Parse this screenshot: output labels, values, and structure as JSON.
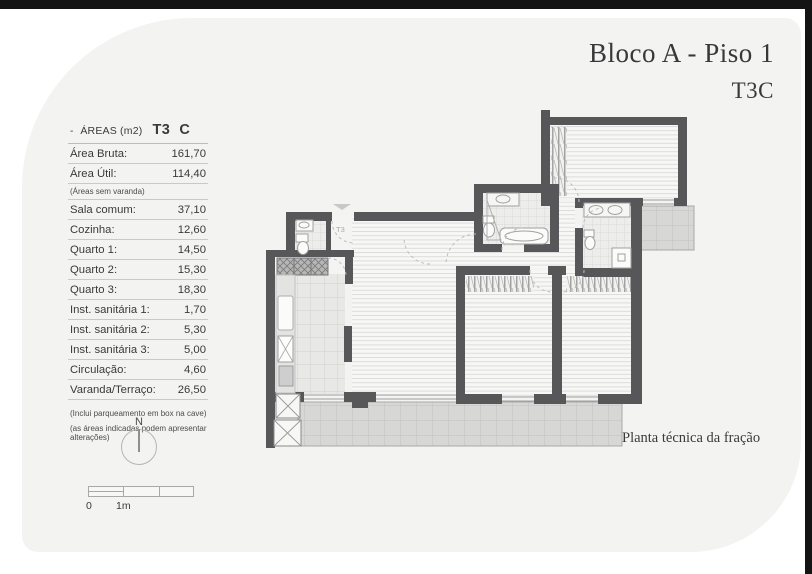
{
  "page": {
    "title_line1": "Bloco A - Piso 1",
    "title_line2": "T3C",
    "plan_caption": "Planta técnica da fração"
  },
  "areas_table": {
    "header": {
      "dash": "-",
      "label": "ÁREAS (m2)",
      "type_code": "T3",
      "fraction": "C"
    },
    "rows": [
      {
        "label": "Área Bruta:",
        "value": "161,70"
      },
      {
        "label": "Área Útil:",
        "value": "114,40"
      },
      {
        "label": "(Áreas sem varanda)",
        "value": "",
        "note": true
      },
      {
        "label": "Sala comum:",
        "value": "37,10"
      },
      {
        "label": "Cozinha:",
        "value": "12,60"
      },
      {
        "label": "Quarto 1:",
        "value": "14,50"
      },
      {
        "label": "Quarto 2:",
        "value": "15,30"
      },
      {
        "label": "Quarto 3:",
        "value": "18,30"
      },
      {
        "label": "Inst. sanitária 1:",
        "value": "1,70"
      },
      {
        "label": "Inst. sanitária 2:",
        "value": "5,30"
      },
      {
        "label": "Inst. sanitária 3:",
        "value": "5,00"
      },
      {
        "label": "Circulação:",
        "value": "4,60"
      },
      {
        "label": "Varanda/Terraço:",
        "value": "26,50"
      }
    ],
    "footnotes": [
      "(Inclui parqueamento em box na cave)",
      "(as áreas indicadas podem apresentar alterações)"
    ]
  },
  "compass": {
    "label": "N"
  },
  "scale_bar": {
    "zero_label": "0",
    "one_label": "1m"
  },
  "plan": {
    "unit_label": "T3"
  },
  "colors": {
    "wall": "#57575a",
    "sheet": "#f3f3f2",
    "frame": "#141414",
    "balcony_tile": "#d7d7d6",
    "room_hatch": "#dcdcdc"
  }
}
